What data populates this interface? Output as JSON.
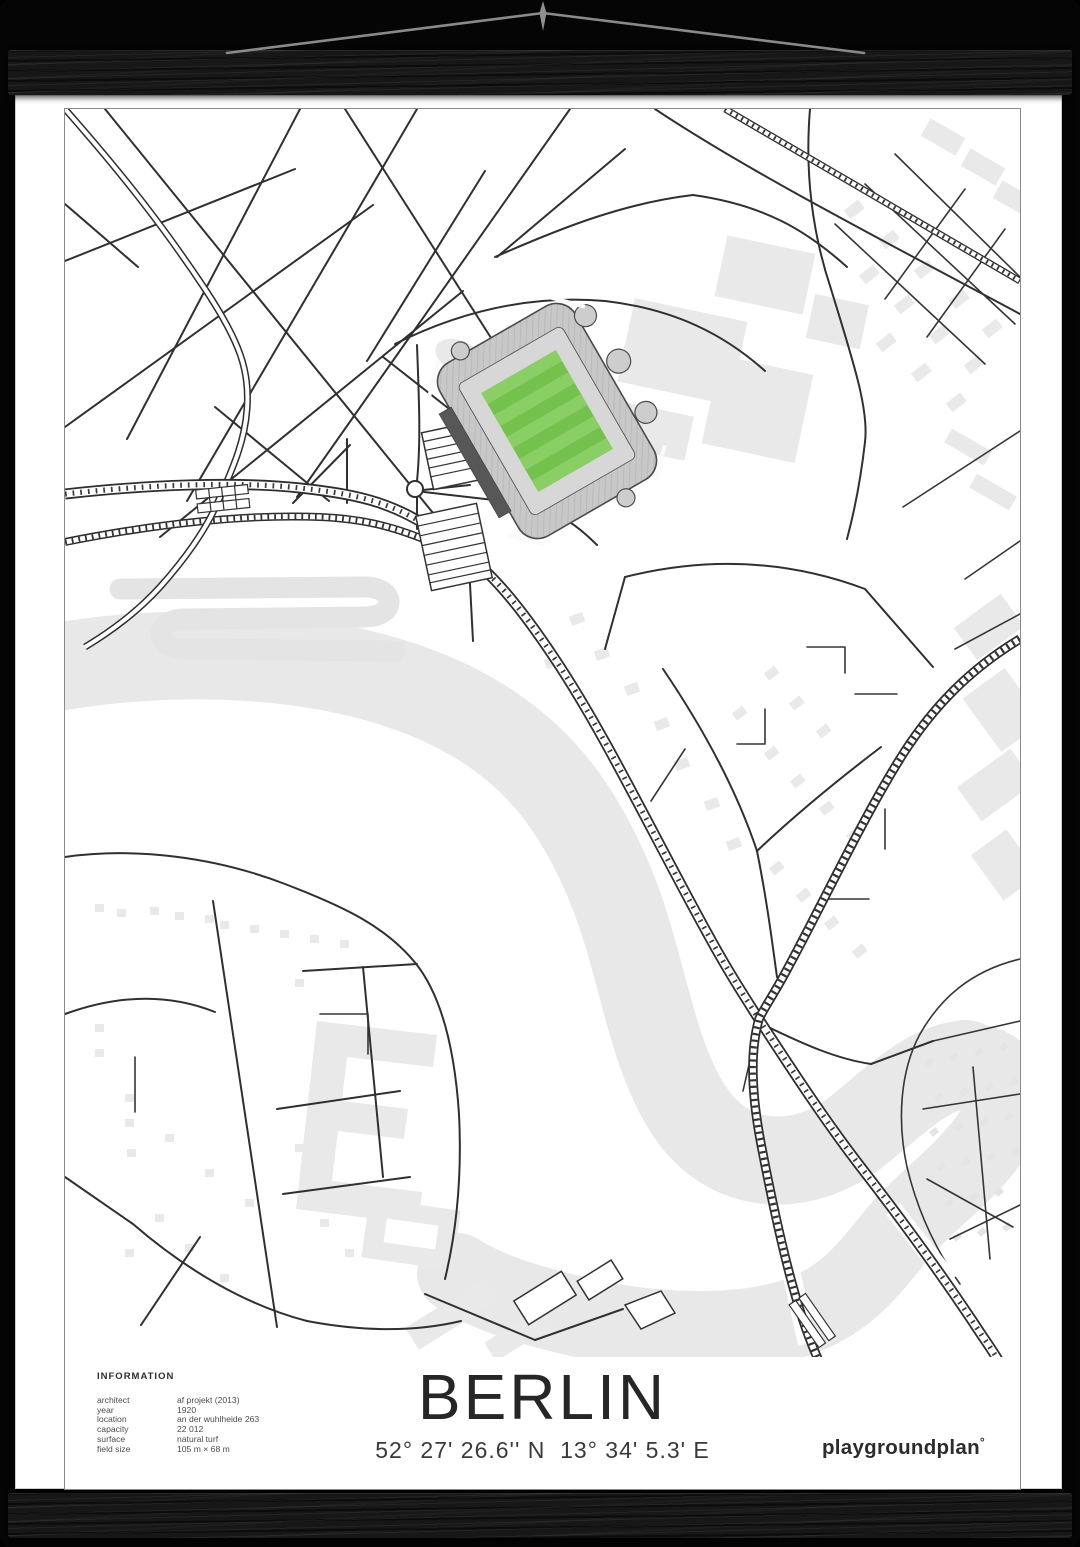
{
  "poster": {
    "title": "BERLIN",
    "coordinates": "52° 27' 26.6'' N  13° 34' 5.3' E",
    "brand": {
      "name": "playgroundplan",
      "mark": "°"
    },
    "information": {
      "heading": "INFORMATION",
      "rows": [
        {
          "label": "architect",
          "value": "af projekt (2013)"
        },
        {
          "label": "year",
          "value": "1920"
        },
        {
          "label": "location",
          "value": "an der wuhlheide 263"
        },
        {
          "label": "capacity",
          "value": "22 012"
        },
        {
          "label": "surface",
          "value": "natural turf"
        },
        {
          "label": "field size",
          "value": "105 m × 68 m"
        }
      ]
    },
    "map": {
      "type": "minimalist stadium street map",
      "pitch_color": "#74c14d",
      "pitch_stripe_color": "#89cf65",
      "river_color": "#e8e8e8",
      "building_color": "#e9e9e9",
      "road_color": "#303030"
    }
  },
  "icons": {
    "nail": "wall-pin",
    "string": "hanging-string",
    "rails": "black-wood-poster-hanger"
  }
}
